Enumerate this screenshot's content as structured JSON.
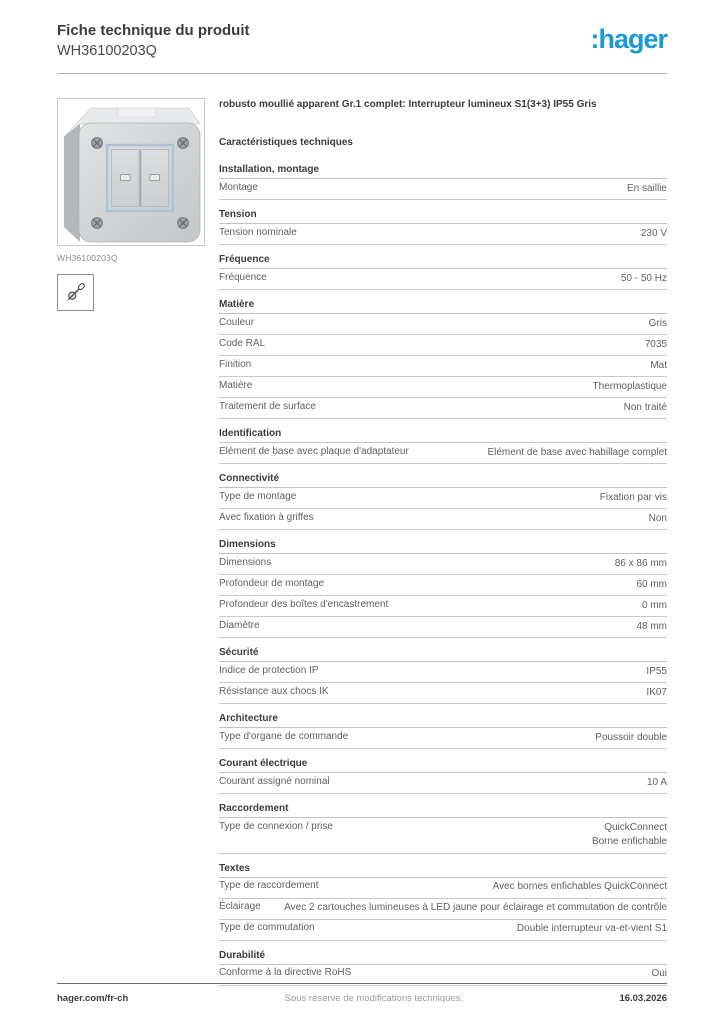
{
  "header": {
    "title": "Fiche technique du produit",
    "product_id": "WH36100203Q",
    "logo_text": ":hager",
    "logo_color": "#1a9ad6"
  },
  "left_column": {
    "image_caption": "WH36100203Q",
    "pictogram_icon": "screw-fixing-icon"
  },
  "main": {
    "description": "robusto moullié apparent Gr.1 complet: Interrupteur lumineux S1(3+3) IP55 Gris",
    "characteristics_heading": "Caractéristiques techniques",
    "sections": [
      {
        "title": "Installation, montage",
        "rows": [
          {
            "label": "Montage",
            "value": "En saillie"
          }
        ]
      },
      {
        "title": "Tension",
        "rows": [
          {
            "label": "Tension nominale",
            "value": "230 V"
          }
        ]
      },
      {
        "title": "Fréquence",
        "rows": [
          {
            "label": "Fréquence",
            "value": "50 - 50 Hz"
          }
        ]
      },
      {
        "title": "Matière",
        "rows": [
          {
            "label": "Couleur",
            "value": "Gris"
          },
          {
            "label": "Code RAL",
            "value": "7035"
          },
          {
            "label": "Finition",
            "value": "Mat"
          },
          {
            "label": "Matière",
            "value": "Thermoplastique"
          },
          {
            "label": "Traitement de surface",
            "value": "Non traité"
          }
        ]
      },
      {
        "title": "Identification",
        "rows": [
          {
            "label": "Elément de base avec plaque d'adaptateur",
            "value": "Elément de base avec habillage complet"
          }
        ]
      },
      {
        "title": "Connectivité",
        "rows": [
          {
            "label": "Type de montage",
            "value": "Fixation par vis"
          },
          {
            "label": "Avec fixation à griffes",
            "value": "Non"
          }
        ]
      },
      {
        "title": "Dimensions",
        "rows": [
          {
            "label": "Dimensions",
            "value": "86 x 86 mm"
          },
          {
            "label": "Profondeur de montage",
            "value": "60 mm"
          },
          {
            "label": "Profondeur des boîtes d'encastrement",
            "value": "0 mm"
          },
          {
            "label": "Diamètre",
            "value": "48 mm"
          }
        ]
      },
      {
        "title": "Sécurité",
        "rows": [
          {
            "label": "Indice de protection IP",
            "value": "IP55"
          },
          {
            "label": "Résistance aux chocs IK",
            "value": "IK07"
          }
        ]
      },
      {
        "title": "Architecture",
        "rows": [
          {
            "label": "Type d'organe de commande",
            "value": "Poussoir double"
          }
        ]
      },
      {
        "title": "Courant électrique",
        "rows": [
          {
            "label": "Courant assigné nominal",
            "value": "10 A"
          }
        ]
      },
      {
        "title": "Raccordement",
        "rows": [
          {
            "label": "Type de connexion / prise",
            "value": "QuickConnect\nBorne enfichable"
          }
        ]
      },
      {
        "title": "Textes",
        "rows": [
          {
            "label": "Type de raccordement",
            "value": "Avec bornes enfichables QuickConnect"
          },
          {
            "label": "Éclairage",
            "value": "Avec 2 cartouches lumineuses à LED jaune pour éclairage et commutation de contrôle"
          },
          {
            "label": "Type de commutation",
            "value": "Double interrupteur va-et-vient S1"
          }
        ]
      },
      {
        "title": "Durabilité",
        "rows": [
          {
            "label": "Conforme à la directive RoHS",
            "value": "Oui"
          }
        ]
      }
    ]
  },
  "footer": {
    "left": "hager.com/fr-ch",
    "center": "Sous réserve de modifications techniques.",
    "right": "16.03.2026"
  }
}
